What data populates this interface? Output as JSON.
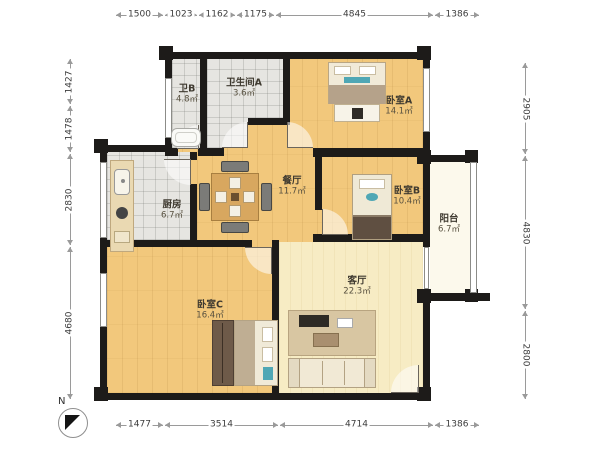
{
  "plan": {
    "type": "apartment-floor-plan",
    "compass_label": "N"
  },
  "rooms": [
    {
      "id": "bath-b",
      "name": "卫B",
      "area": "4.8㎡"
    },
    {
      "id": "bath-a",
      "name": "卫生间A",
      "area": "3.6㎡"
    },
    {
      "id": "bedroom-a",
      "name": "卧室A",
      "area": "14.1㎡"
    },
    {
      "id": "kitchen",
      "name": "厨房",
      "area": "6.7㎡"
    },
    {
      "id": "dining",
      "name": "餐厅",
      "area": "11.7㎡"
    },
    {
      "id": "bedroom-b",
      "name": "卧室B",
      "area": "10.4㎡"
    },
    {
      "id": "balcony",
      "name": "阳台",
      "area": "6.7㎡"
    },
    {
      "id": "bedroom-c",
      "name": "卧室C",
      "area": "16.4㎡"
    },
    {
      "id": "living",
      "name": "客厅",
      "area": "22.3㎡"
    }
  ],
  "dimensions": {
    "top": [
      "1500",
      "1023",
      "1162",
      "1175",
      "4845",
      "1386"
    ],
    "bottom": [
      "1477",
      "3514",
      "4714",
      "1386"
    ],
    "left": [
      "1427",
      "1478",
      "2830",
      "4680"
    ],
    "right": [
      "2905",
      "4830",
      "2800"
    ]
  },
  "colors": {
    "wall": "#1d1b19",
    "wood_floor": "#f2c87c",
    "tile_floor": "#e6e5e1",
    "living_floor": "#f7ecc4",
    "balcony_floor": "#fcf9ec",
    "accent_teal": "#4fa7b5"
  }
}
